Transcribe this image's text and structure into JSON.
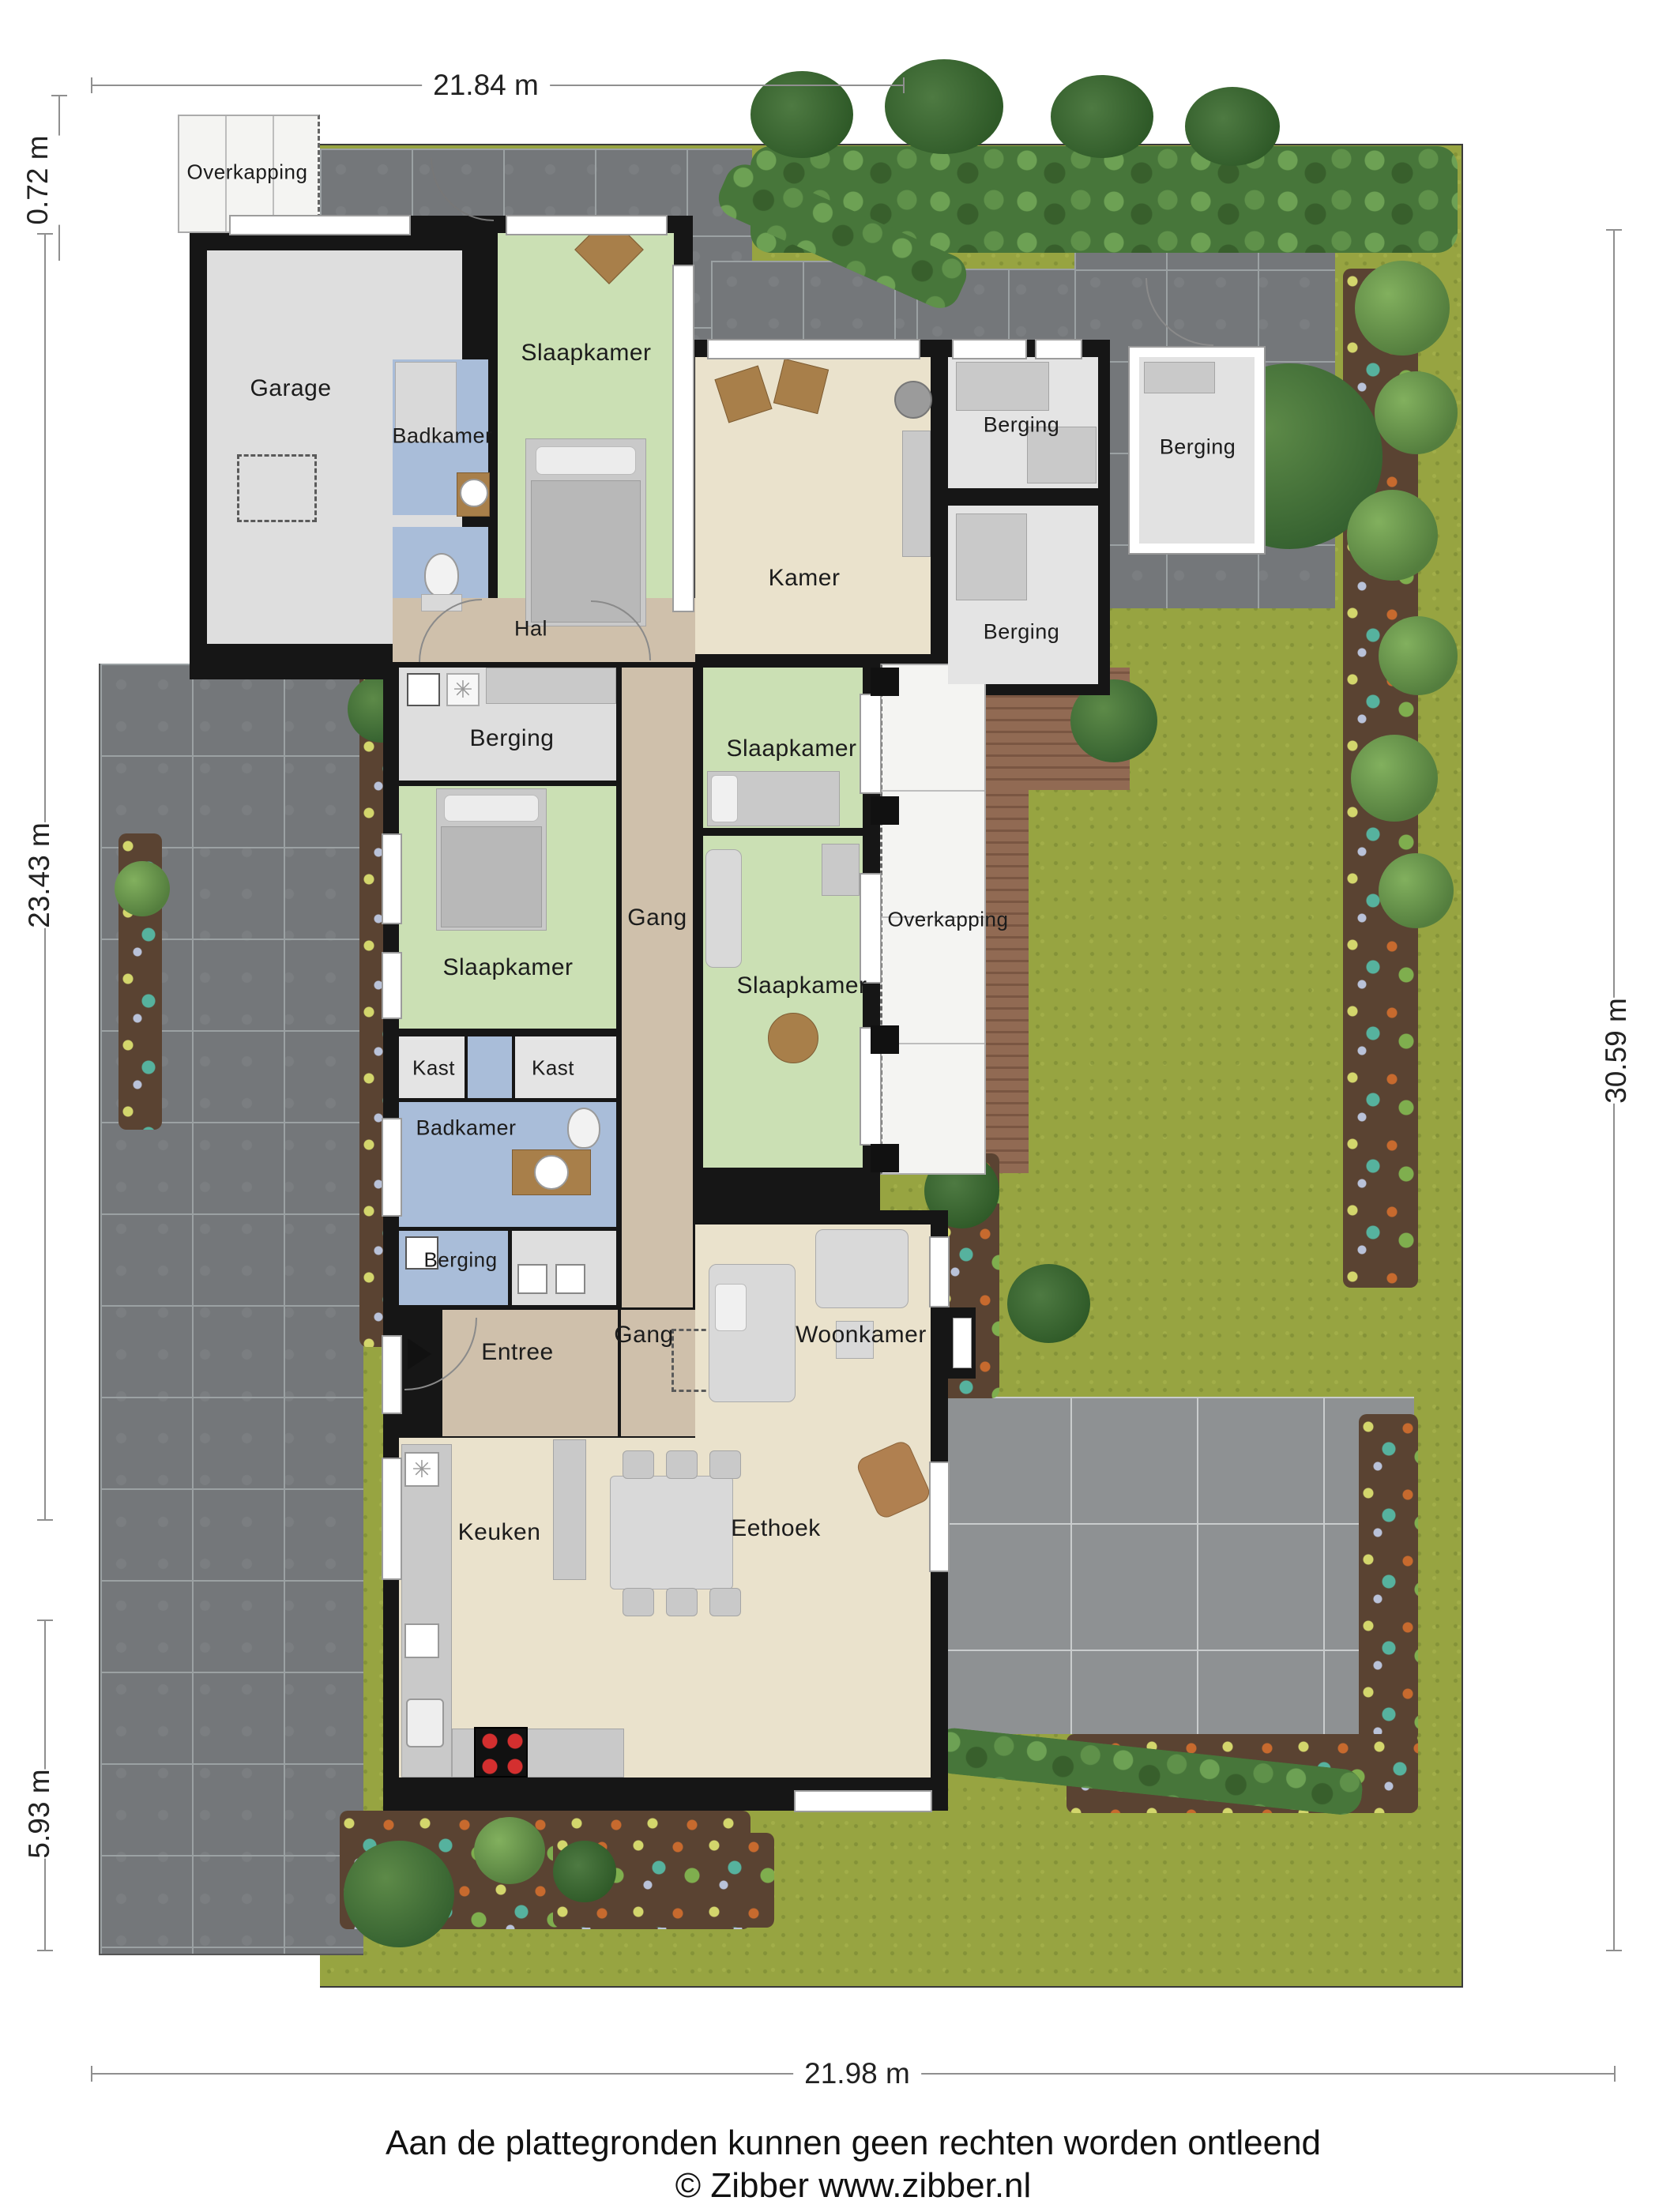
{
  "dimensions": {
    "top": "21.84 m",
    "bottom": "21.98 m",
    "right": "30.59 m",
    "left_top": "0.72 m",
    "left_middle": "23.43 m",
    "left_bottom": "5.93 m"
  },
  "rooms": {
    "overkapping_top": "Overkapping",
    "garage": "Garage",
    "badkamer_top": "Badkamer",
    "slaapkamer_top": "Slaapkamer",
    "kamer": "Kamer",
    "berging_binnen_boven": "Berging",
    "berging_vrijstaand": "Berging",
    "berging_binnen_onder": "Berging",
    "hal": "Hal",
    "berging_midden": "Berging",
    "gang_boven": "Gang",
    "slaapkamer_links": "Slaapkamer",
    "slaapkamer_rechts_boven": "Slaapkamer",
    "overkapping_midden": "Overkapping",
    "slaapkamer_rechts_onder": "Slaapkamer",
    "kast_links": "Kast",
    "kast_rechts": "Kast",
    "badkamer_midden": "Badkamer",
    "berging_klein": "Berging",
    "entree": "Entree",
    "gang_onder": "Gang",
    "woonkamer": "Woonkamer",
    "keuken": "Keuken",
    "eethoek": "Eethoek"
  },
  "footer": {
    "line1": "Aan de plattegronden kunnen geen rechten worden ontleend",
    "line2": "© Zibber www.zibber.nl"
  },
  "colors": {
    "bedroom_green": "#cbe0b4",
    "bathroom_blue": "#a9bdd9",
    "hall_tan": "#cfc0ab",
    "living_beige": "#eae2cc",
    "storage_gray": "#dedede",
    "wall_black": "#161616",
    "grass_green": "#97a441",
    "paving_gray": "#74777a",
    "stove_red": "#d42f2f"
  }
}
